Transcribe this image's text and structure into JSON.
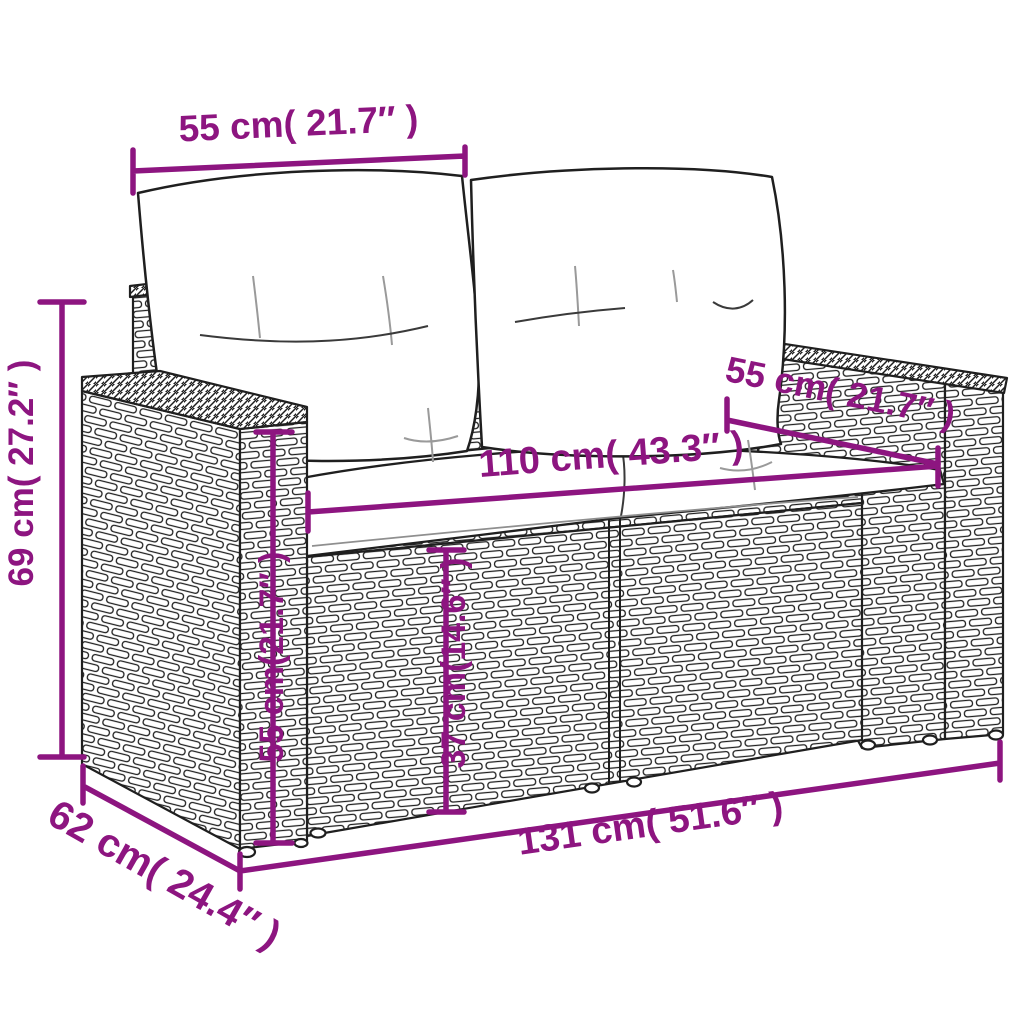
{
  "diagram": {
    "background": "#FFFFFF",
    "accent": "#8D1580",
    "line_art_color": "#1F1F1F",
    "labels": {
      "backrest_width": "55 cm( 21.7″ )",
      "overall_height": "69 cm( 27.2″ )",
      "armrest_length": "55 cm( 21.7″ )",
      "seat_width": "110 cm( 43.3″ )",
      "armrest_height": "55 cm(21.7″ )",
      "seat_height": "37 cm(14.6″ )",
      "overall_width": "131 cm( 51.6″ )",
      "overall_depth": "62 cm( 24.4″ )"
    }
  }
}
